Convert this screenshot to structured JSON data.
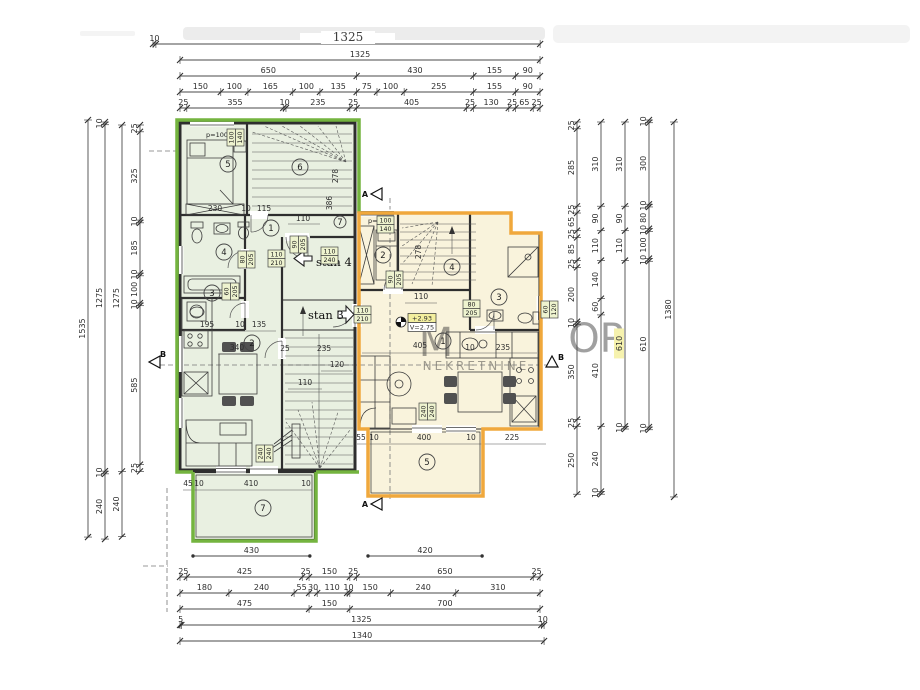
{
  "drawing": {
    "stan_left_entry_label": "stan 4",
    "stan_right_entry_label": "stan 3",
    "level_marker": {
      "height": "+2.93",
      "clearance": "V=2.75"
    },
    "section_markers": [
      "A",
      "A",
      "B",
      "B"
    ],
    "watermark": {
      "letter": "M",
      "letters": "OP",
      "word": "NEKRETNINE"
    },
    "colors": {
      "green_outline": "#74b43f",
      "green_fill": "#e9f0e1",
      "orange_outline": "#f0a83c",
      "orange_fill": "#f9f3dc",
      "label_highlight": "#eef3cf",
      "level_highlight": "#f3ef9e",
      "wall": "#2e2e2e",
      "dim_text": "#2e2e2e"
    }
  },
  "dims": {
    "top": [
      [
        "10",
        "1325"
      ],
      [
        "1325"
      ],
      [
        "650",
        "430",
        "155",
        "90"
      ],
      [
        "150",
        "100",
        "165",
        "100",
        "135",
        "75",
        "100",
        "255",
        "155",
        "90"
      ],
      [
        "25",
        "355",
        "10",
        "235",
        "25",
        "405",
        "25",
        "130",
        "25",
        "65",
        "25"
      ]
    ],
    "bottom_upper": [
      [
        "430"
      ],
      [
        "420"
      ]
    ],
    "bottom": [
      [
        "25",
        "425",
        "25",
        "150",
        "25",
        "650",
        "25"
      ],
      [
        "180",
        "240",
        "55",
        "30",
        "110",
        "10",
        "150",
        "240",
        "310"
      ],
      [
        "475",
        "150",
        "700"
      ],
      [
        "5",
        "1325",
        "10"
      ],
      [
        "1340"
      ]
    ],
    "left": [
      [
        "1535"
      ],
      [
        "10",
        "1275",
        "10",
        "240"
      ],
      [
        "1275",
        "240"
      ],
      [
        "25",
        "325",
        "10",
        "185",
        "10",
        "100",
        "10",
        "585",
        "25"
      ]
    ],
    "right": [
      [
        "25",
        "285",
        "25",
        "65",
        "25",
        "85",
        "25",
        "200",
        "10",
        "350",
        "25",
        "250"
      ],
      [
        "310",
        "90",
        "110",
        "140",
        "60",
        "410",
        "240",
        "10"
      ],
      [
        "310",
        "90",
        "110",
        "610",
        "10"
      ],
      [
        "10",
        "300",
        "10",
        "80",
        "10",
        "100",
        "10",
        "610",
        "10"
      ],
      [
        "1380"
      ]
    ]
  },
  "plan_dimensions": [
    "230",
    "10",
    "115",
    "110",
    "195",
    "10",
    "135",
    "340",
    "25",
    "235",
    "120",
    "110",
    "45",
    "10",
    "410",
    "10",
    "110",
    "405",
    "10",
    "235",
    "55",
    "10",
    "400",
    "10",
    "225"
  ],
  "stair_labels": [
    "278",
    "386",
    "278"
  ],
  "window_notes": [
    "p=100",
    "p=100"
  ],
  "door_window_labels": [
    {
      "w": "110",
      "h": "210"
    },
    {
      "w": "110",
      "h": "210"
    },
    {
      "w": "90",
      "h": "205"
    },
    {
      "w": "110",
      "h": "240"
    },
    {
      "w": "80",
      "h": "205"
    },
    {
      "w": "240",
      "h": "240"
    },
    {
      "w": "60",
      "h": "205"
    },
    {
      "w": "90",
      "h": "205"
    },
    {
      "w": "80",
      "h": "205"
    },
    {
      "w": "60",
      "h": "120"
    },
    {
      "w": "240",
      "h": "240"
    },
    {
      "w": "100",
      "h": "140"
    },
    {
      "w": "100",
      "h": "140"
    }
  ],
  "room_circles": [
    "5",
    "6",
    "7",
    "1",
    "4",
    "3",
    "2",
    "7",
    "2",
    "4",
    "3",
    "1",
    "5"
  ]
}
